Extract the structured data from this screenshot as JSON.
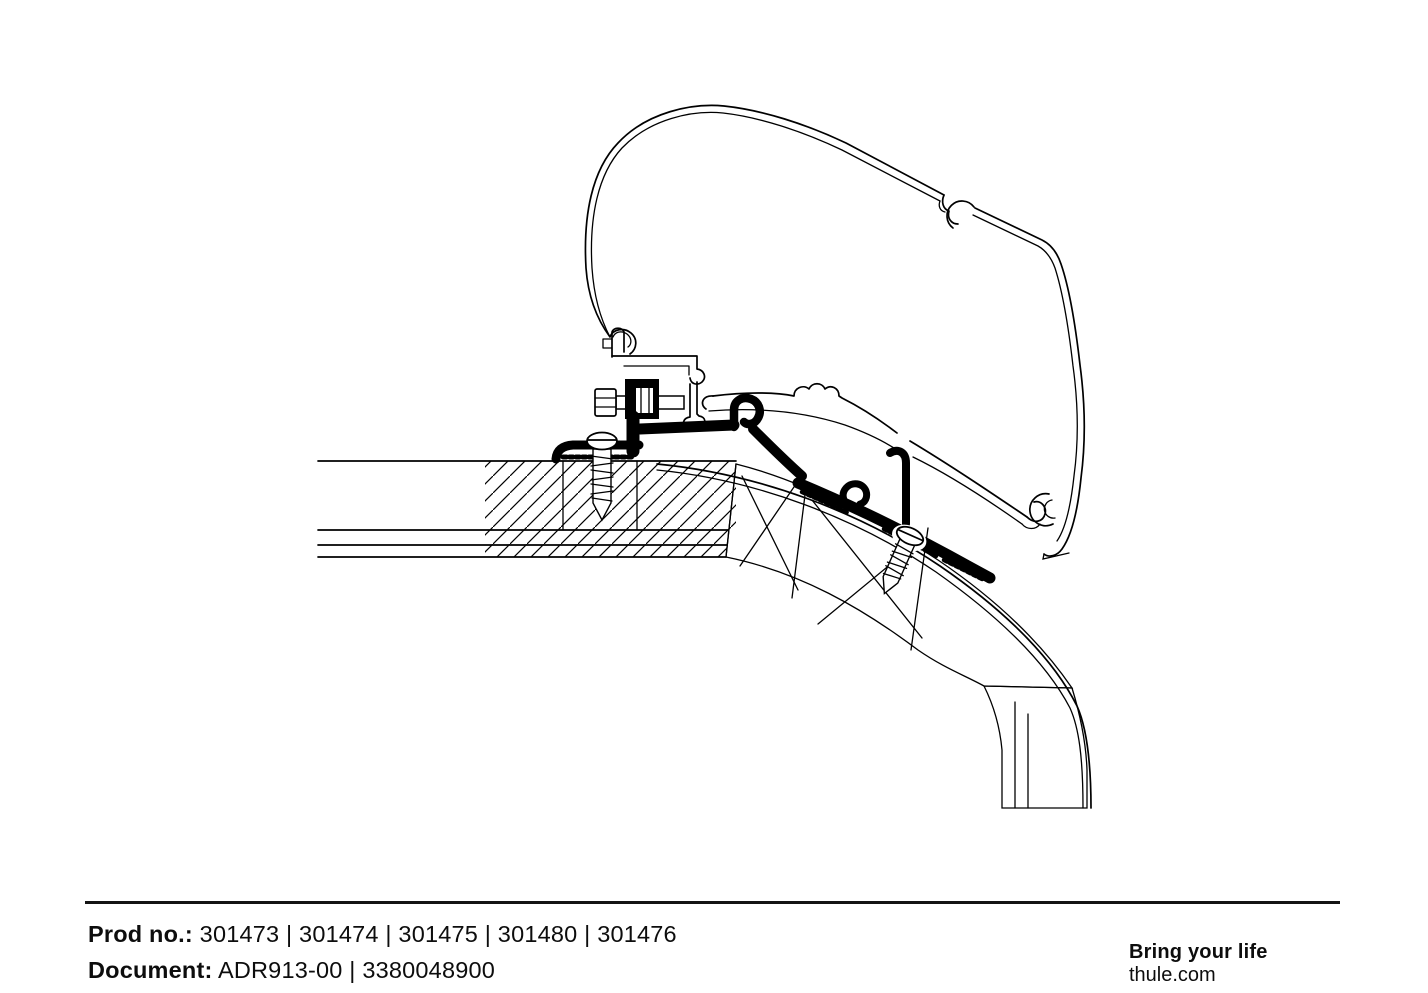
{
  "page": {
    "background": "#ffffff",
    "ink": "#000000"
  },
  "drawing": {
    "description": "Cross-section technical line drawing of an awning rail adapter clamped to a curved vehicle roof with mounting screws and bolt",
    "components": [
      "awning-cassette-profile",
      "awning-rail-profile",
      "adapter-bracket",
      "clamp-foot",
      "hex-bolt-with-nut",
      "vertical-roof-screw",
      "angled-roof-screw",
      "vehicle-roof-cross-section"
    ]
  },
  "footer": {
    "prod": {
      "label": "Prod no.:",
      "value": "301473 | 301474 | 301475 | 301480 | 301476"
    },
    "document": {
      "label": "Document:",
      "value": "ADR913-00 | 3380048900"
    }
  },
  "branding": {
    "tagline": "Bring your life",
    "website": "thule.com"
  }
}
